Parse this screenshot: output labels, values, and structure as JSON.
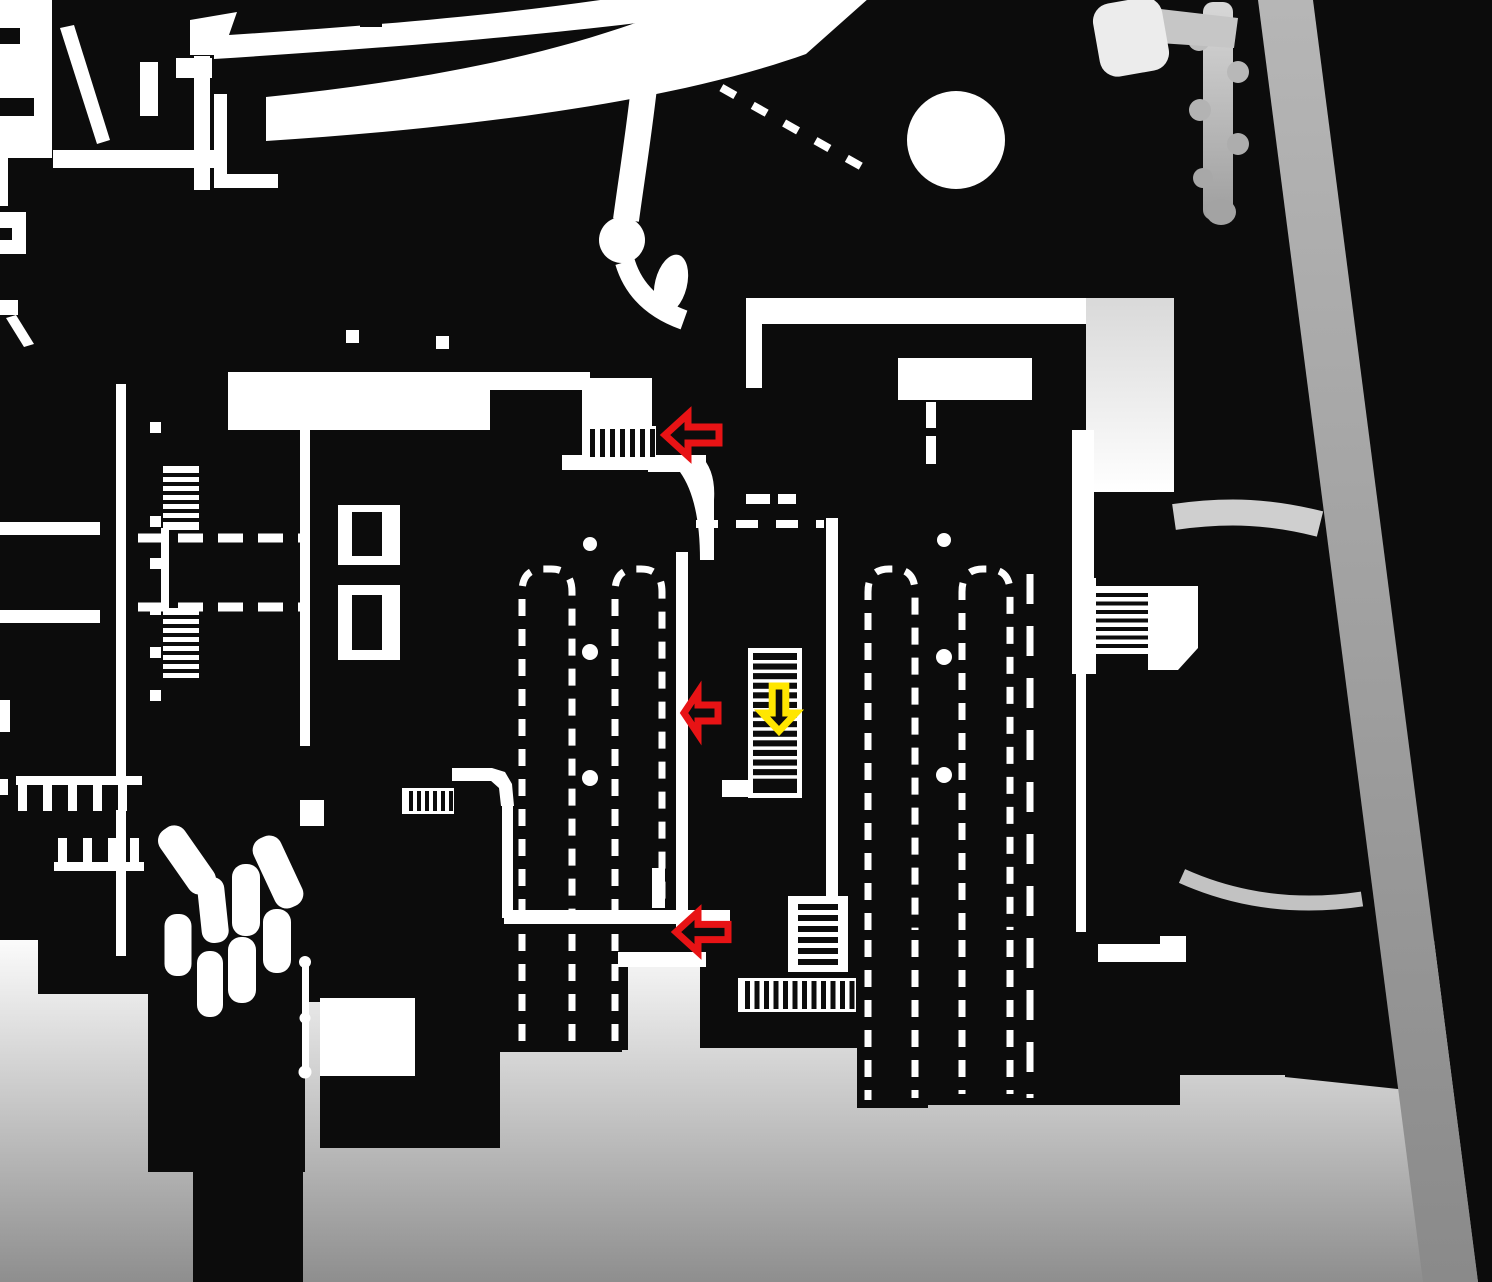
{
  "title": "monochrome level map with route arrows",
  "map": {
    "background_color": "#0c0c0c",
    "floor_color": "#ffffff",
    "road_color_top": "#b6b6b6",
    "road_color_bottom": "#8a8a8a",
    "fog_color_top": "#fbfbfb",
    "fog_color_bottom": "#8e8e8e",
    "path_color": "#cfcfcf"
  },
  "annotations": {
    "colors": {
      "red": "#e81315",
      "yellow": "#ffe600"
    },
    "stroke_width": 7,
    "arrows": [
      {
        "name": "red-arrow-upper-stairs",
        "color": "red",
        "dir": "left",
        "x": 665,
        "y": 414,
        "w": 54,
        "h": 42
      },
      {
        "name": "red-arrow-middle-lane",
        "color": "red",
        "dir": "left",
        "x": 684,
        "y": 692,
        "w": 34,
        "h": 42
      },
      {
        "name": "red-arrow-lower-lane",
        "color": "red",
        "dir": "left",
        "x": 676,
        "y": 912,
        "w": 52,
        "h": 40
      },
      {
        "name": "yellow-arrow-central-stairs",
        "color": "yellow",
        "dir": "down",
        "x": 762,
        "y": 686,
        "w": 34,
        "h": 45
      }
    ]
  }
}
